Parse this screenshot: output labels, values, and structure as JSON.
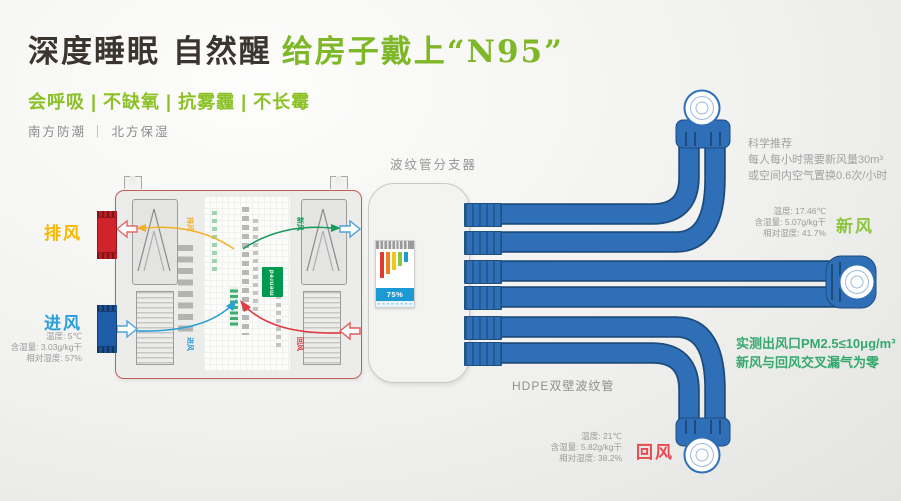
{
  "header": {
    "title_black": "深度睡眠 自然醒",
    "title_green": "给房子戴上“N95”",
    "tagline": "会呼吸 | 不缺氧 | 抗雾霾 | 不长霉",
    "subline": "南方防潮 ｜ 北方保湿"
  },
  "labels": {
    "splitter": "波纹管分支器",
    "hdpe_pipe": "HDPE双壁波纹管"
  },
  "science": {
    "l1": "科学推荐",
    "l2": "每人每小时需要新风量30m³",
    "l3": "或空间内空气置换0.6次/小时"
  },
  "measured": {
    "l1": "实测出风口PM2.5≤10μg/m³",
    "l2": "新风与回风交叉漏气为零"
  },
  "streams": {
    "exhaust": {
      "label": "排风",
      "color": "#f5b700"
    },
    "intake": {
      "label": "进风",
      "color": "#2a9fd8",
      "temp": "温度: 5℃",
      "moisture": "含湿量: 3.03g/kg干",
      "rh": "相对湿度: 57%"
    },
    "fresh": {
      "label": "新风",
      "color": "#8cc63f",
      "temp": "温度: 17.46℃",
      "moisture": "含湿量: 5.07g/kg干",
      "rh": "相对湿度: 41.7%"
    },
    "return": {
      "label": "回风",
      "color": "#e84a50",
      "temp": "温度: 21℃",
      "moisture": "含湿量: 5.82g/kg干",
      "rh": "相对湿度: 38.2%"
    }
  },
  "machine": {
    "brand": "menred",
    "efficiency": "75%",
    "inner_labels": {
      "exhaust": "排风",
      "fresh": "新风",
      "intake": "进风",
      "return": "回风"
    }
  },
  "palette": {
    "accent_green": "#7eb727",
    "pipe_blue": "#2e6fb7",
    "pipe_outline": "#1d4b7c"
  }
}
